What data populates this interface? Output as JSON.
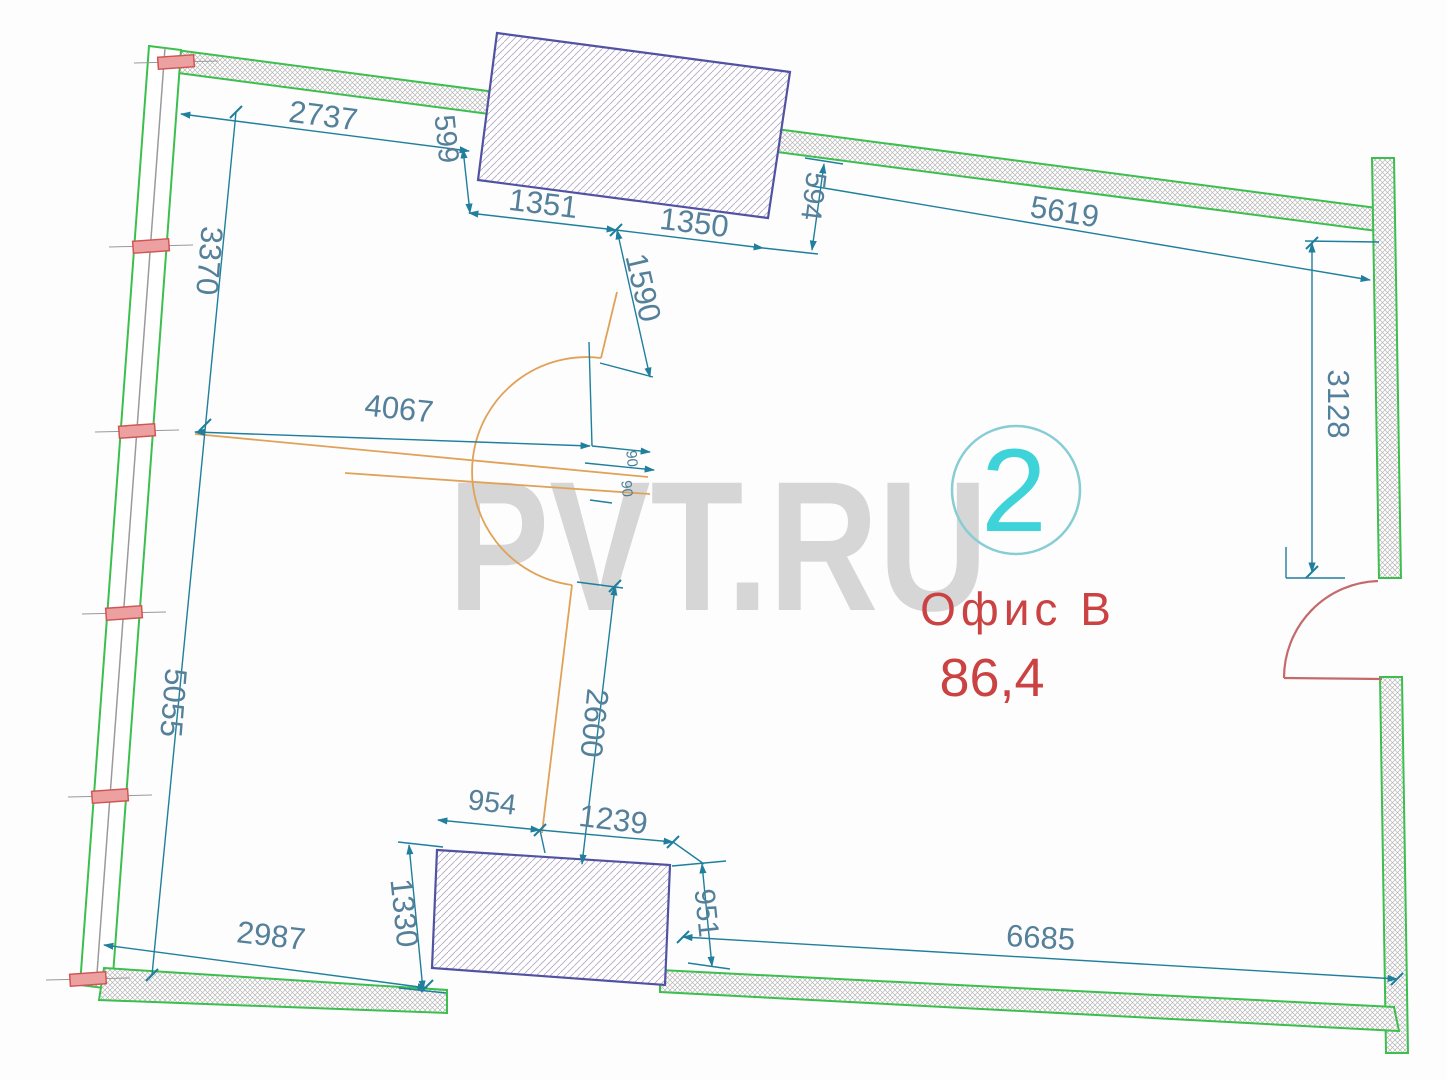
{
  "watermark": {
    "text": "PVT.RU"
  },
  "room": {
    "number": "2",
    "name": "Офис В",
    "area": "86,4"
  },
  "dimensions": {
    "top_left": "2737",
    "top_block_offset_left": "599",
    "top_block_left": "1351",
    "top_block_right": "1350",
    "top_block_offset_right": "594",
    "top_right": "5619",
    "left_upper": "3370",
    "left_lower": "5055",
    "right_upper": "3128",
    "mid_horizontal": "4067",
    "mid_vertical_upper": "1590",
    "mid_small_a": "90",
    "mid_small_b": "90",
    "mid_vertical_lower": "2600",
    "bottom_block_top_left": "954",
    "bottom_block_top_right": "1239",
    "bottom_block_height_left": "1330",
    "bottom_block_height_right": "951",
    "bottom_left": "2987",
    "bottom_right": "6685"
  },
  "colors": {
    "wall_green": "#3cbf4e",
    "dimension_line": "#1f7f9d",
    "dimension_text": "#54809a",
    "block_outline": "#5252a3",
    "door_red": "#c46a6a",
    "window_tick_red": "#d05555",
    "label_red": "#cb4242",
    "unit_cyan": "#3ed3d9",
    "hatch_gray": "#b6b6b6",
    "orange": "#e0a258",
    "watermark_gray": "#d0d0d0"
  }
}
